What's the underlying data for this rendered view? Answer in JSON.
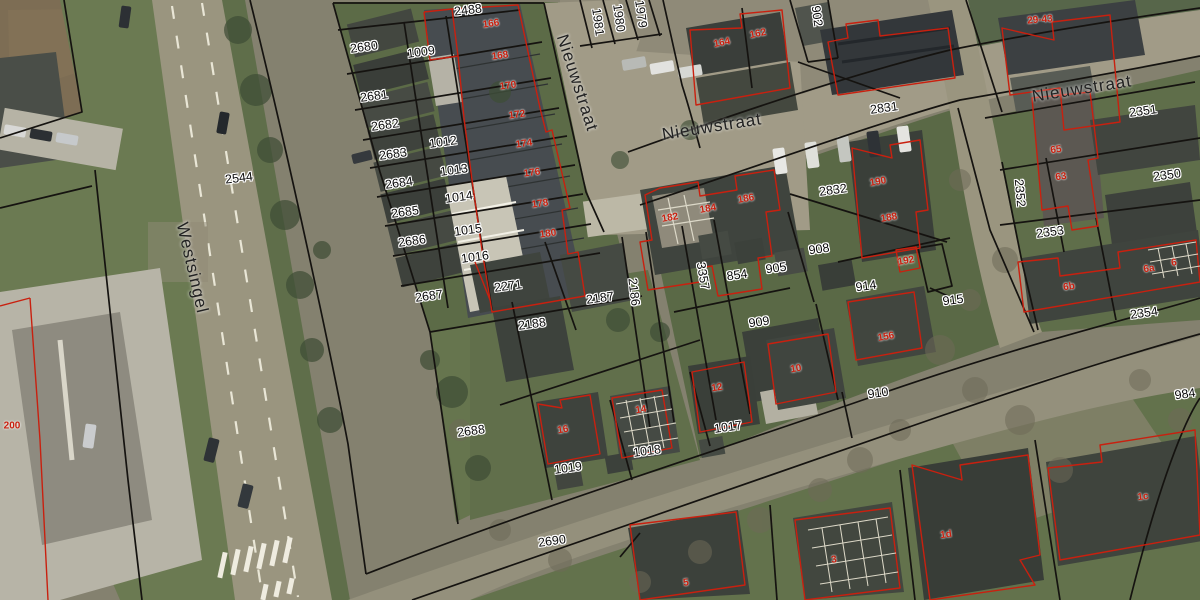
{
  "map": {
    "description": "Cadastral parcel map over aerial photo",
    "colors": {
      "parcel_line": "#151310",
      "building_outline": "#c9200f",
      "parcel_text": "#0a0a0a",
      "house_text": "#c9200f",
      "label_halo": "#ffffff"
    },
    "street_labels": [
      {
        "t": "Nieuwstraat",
        "x": 577,
        "y": 83,
        "r": 72
      },
      {
        "t": "Nieuwstraat",
        "x": 712,
        "y": 127,
        "r": -9
      },
      {
        "t": "Nieuwstraat",
        "x": 1082,
        "y": 89,
        "r": -9
      },
      {
        "t": "Westsingel",
        "x": 192,
        "y": 268,
        "r": 77
      }
    ],
    "parcel_labels": [
      {
        "t": "2488",
        "x": 468,
        "y": 10,
        "r": -7
      },
      {
        "t": "2680",
        "x": 364,
        "y": 47,
        "r": -8
      },
      {
        "t": "1009",
        "x": 421,
        "y": 52,
        "r": -8
      },
      {
        "t": "2681",
        "x": 374,
        "y": 96,
        "r": -8
      },
      {
        "t": "2682",
        "x": 385,
        "y": 125,
        "r": -8
      },
      {
        "t": "1012",
        "x": 443,
        "y": 142,
        "r": -8
      },
      {
        "t": "2683",
        "x": 393,
        "y": 154,
        "r": -8
      },
      {
        "t": "1013",
        "x": 454,
        "y": 170,
        "r": -8
      },
      {
        "t": "2684",
        "x": 399,
        "y": 183,
        "r": -8
      },
      {
        "t": "1014",
        "x": 459,
        "y": 197,
        "r": -8
      },
      {
        "t": "2685",
        "x": 405,
        "y": 212,
        "r": -8
      },
      {
        "t": "1015",
        "x": 468,
        "y": 230,
        "r": -8
      },
      {
        "t": "2686",
        "x": 412,
        "y": 241,
        "r": -8
      },
      {
        "t": "1016",
        "x": 475,
        "y": 257,
        "r": -8
      },
      {
        "t": "2687",
        "x": 429,
        "y": 296,
        "r": -8
      },
      {
        "t": "2271",
        "x": 508,
        "y": 286,
        "r": -8
      },
      {
        "t": "2187",
        "x": 600,
        "y": 298,
        "r": -8
      },
      {
        "t": "2186",
        "x": 634,
        "y": 292,
        "r": 83
      },
      {
        "t": "2188",
        "x": 532,
        "y": 324,
        "r": -8
      },
      {
        "t": "2688",
        "x": 471,
        "y": 431,
        "r": -8
      },
      {
        "t": "1019",
        "x": 568,
        "y": 468,
        "r": -8
      },
      {
        "t": "1018",
        "x": 647,
        "y": 451,
        "r": -8
      },
      {
        "t": "1017",
        "x": 728,
        "y": 427,
        "r": -8
      },
      {
        "t": "2690",
        "x": 552,
        "y": 541,
        "r": -8
      },
      {
        "t": "2544",
        "x": 239,
        "y": 178,
        "r": -7
      },
      {
        "t": "1981",
        "x": 598,
        "y": 22,
        "r": 82
      },
      {
        "t": "1980",
        "x": 619,
        "y": 18,
        "r": 82
      },
      {
        "t": "1979",
        "x": 641,
        "y": 14,
        "r": 82
      },
      {
        "t": "902",
        "x": 817,
        "y": 16,
        "r": 82
      },
      {
        "t": "2831",
        "x": 884,
        "y": 108,
        "r": -8
      },
      {
        "t": "2832",
        "x": 833,
        "y": 190,
        "r": -8
      },
      {
        "t": "908",
        "x": 819,
        "y": 249,
        "r": -8
      },
      {
        "t": "905",
        "x": 776,
        "y": 268,
        "r": -8
      },
      {
        "t": "854",
        "x": 737,
        "y": 275,
        "r": -8
      },
      {
        "t": "3357",
        "x": 703,
        "y": 276,
        "r": 80
      },
      {
        "t": "914",
        "x": 866,
        "y": 286,
        "r": -8
      },
      {
        "t": "915",
        "x": 953,
        "y": 300,
        "r": -8
      },
      {
        "t": "909",
        "x": 759,
        "y": 322,
        "r": -8
      },
      {
        "t": "910",
        "x": 878,
        "y": 393,
        "r": -8
      },
      {
        "t": "2351",
        "x": 1143,
        "y": 111,
        "r": -8
      },
      {
        "t": "2350",
        "x": 1167,
        "y": 175,
        "r": -8
      },
      {
        "t": "2352",
        "x": 1020,
        "y": 193,
        "r": 85
      },
      {
        "t": "2353",
        "x": 1050,
        "y": 232,
        "r": -8
      },
      {
        "t": "2354",
        "x": 1144,
        "y": 313,
        "r": -8
      },
      {
        "t": "984",
        "x": 1185,
        "y": 394,
        "r": -8
      }
    ],
    "house_labels": [
      {
        "t": "166",
        "x": 491,
        "y": 24,
        "r": -8
      },
      {
        "t": "168",
        "x": 500,
        "y": 56,
        "r": -8
      },
      {
        "t": "170",
        "x": 508,
        "y": 86,
        "r": -8
      },
      {
        "t": "172",
        "x": 517,
        "y": 115,
        "r": -8
      },
      {
        "t": "174",
        "x": 524,
        "y": 144,
        "r": -8
      },
      {
        "t": "176",
        "x": 532,
        "y": 173,
        "r": -8
      },
      {
        "t": "178",
        "x": 540,
        "y": 204,
        "r": -8
      },
      {
        "t": "180",
        "x": 548,
        "y": 234,
        "r": -8
      },
      {
        "t": "164",
        "x": 722,
        "y": 43,
        "r": -12
      },
      {
        "t": "162",
        "x": 758,
        "y": 34,
        "r": -12
      },
      {
        "t": "29-43",
        "x": 1040,
        "y": 20,
        "r": -5
      },
      {
        "t": "182",
        "x": 670,
        "y": 218,
        "r": -10
      },
      {
        "t": "184",
        "x": 708,
        "y": 209,
        "r": -10
      },
      {
        "t": "186",
        "x": 746,
        "y": 199,
        "r": -10
      },
      {
        "t": "190",
        "x": 878,
        "y": 182,
        "r": -10
      },
      {
        "t": "188",
        "x": 889,
        "y": 218,
        "r": -10
      },
      {
        "t": "192",
        "x": 906,
        "y": 261,
        "r": -10
      },
      {
        "t": "65",
        "x": 1056,
        "y": 150,
        "r": -8
      },
      {
        "t": "63",
        "x": 1061,
        "y": 177,
        "r": -8
      },
      {
        "t": "156",
        "x": 886,
        "y": 337,
        "r": -10
      },
      {
        "t": "10",
        "x": 796,
        "y": 369,
        "r": -10
      },
      {
        "t": "12",
        "x": 717,
        "y": 388,
        "r": -10
      },
      {
        "t": "14",
        "x": 641,
        "y": 410,
        "r": -10
      },
      {
        "t": "16",
        "x": 563,
        "y": 430,
        "r": -10
      },
      {
        "t": "6",
        "x": 1174,
        "y": 263,
        "r": -8
      },
      {
        "t": "6a",
        "x": 1149,
        "y": 269,
        "r": -8
      },
      {
        "t": "6b",
        "x": 1069,
        "y": 287,
        "r": -8
      },
      {
        "t": "1d",
        "x": 946,
        "y": 535,
        "r": -8
      },
      {
        "t": "1c",
        "x": 1143,
        "y": 497,
        "r": -8
      },
      {
        "t": "5",
        "x": 686,
        "y": 583,
        "r": -8
      },
      {
        "t": "3",
        "x": 834,
        "y": 560,
        "r": -8
      },
      {
        "t": "200",
        "x": 12,
        "y": 426,
        "r": 0
      }
    ]
  }
}
